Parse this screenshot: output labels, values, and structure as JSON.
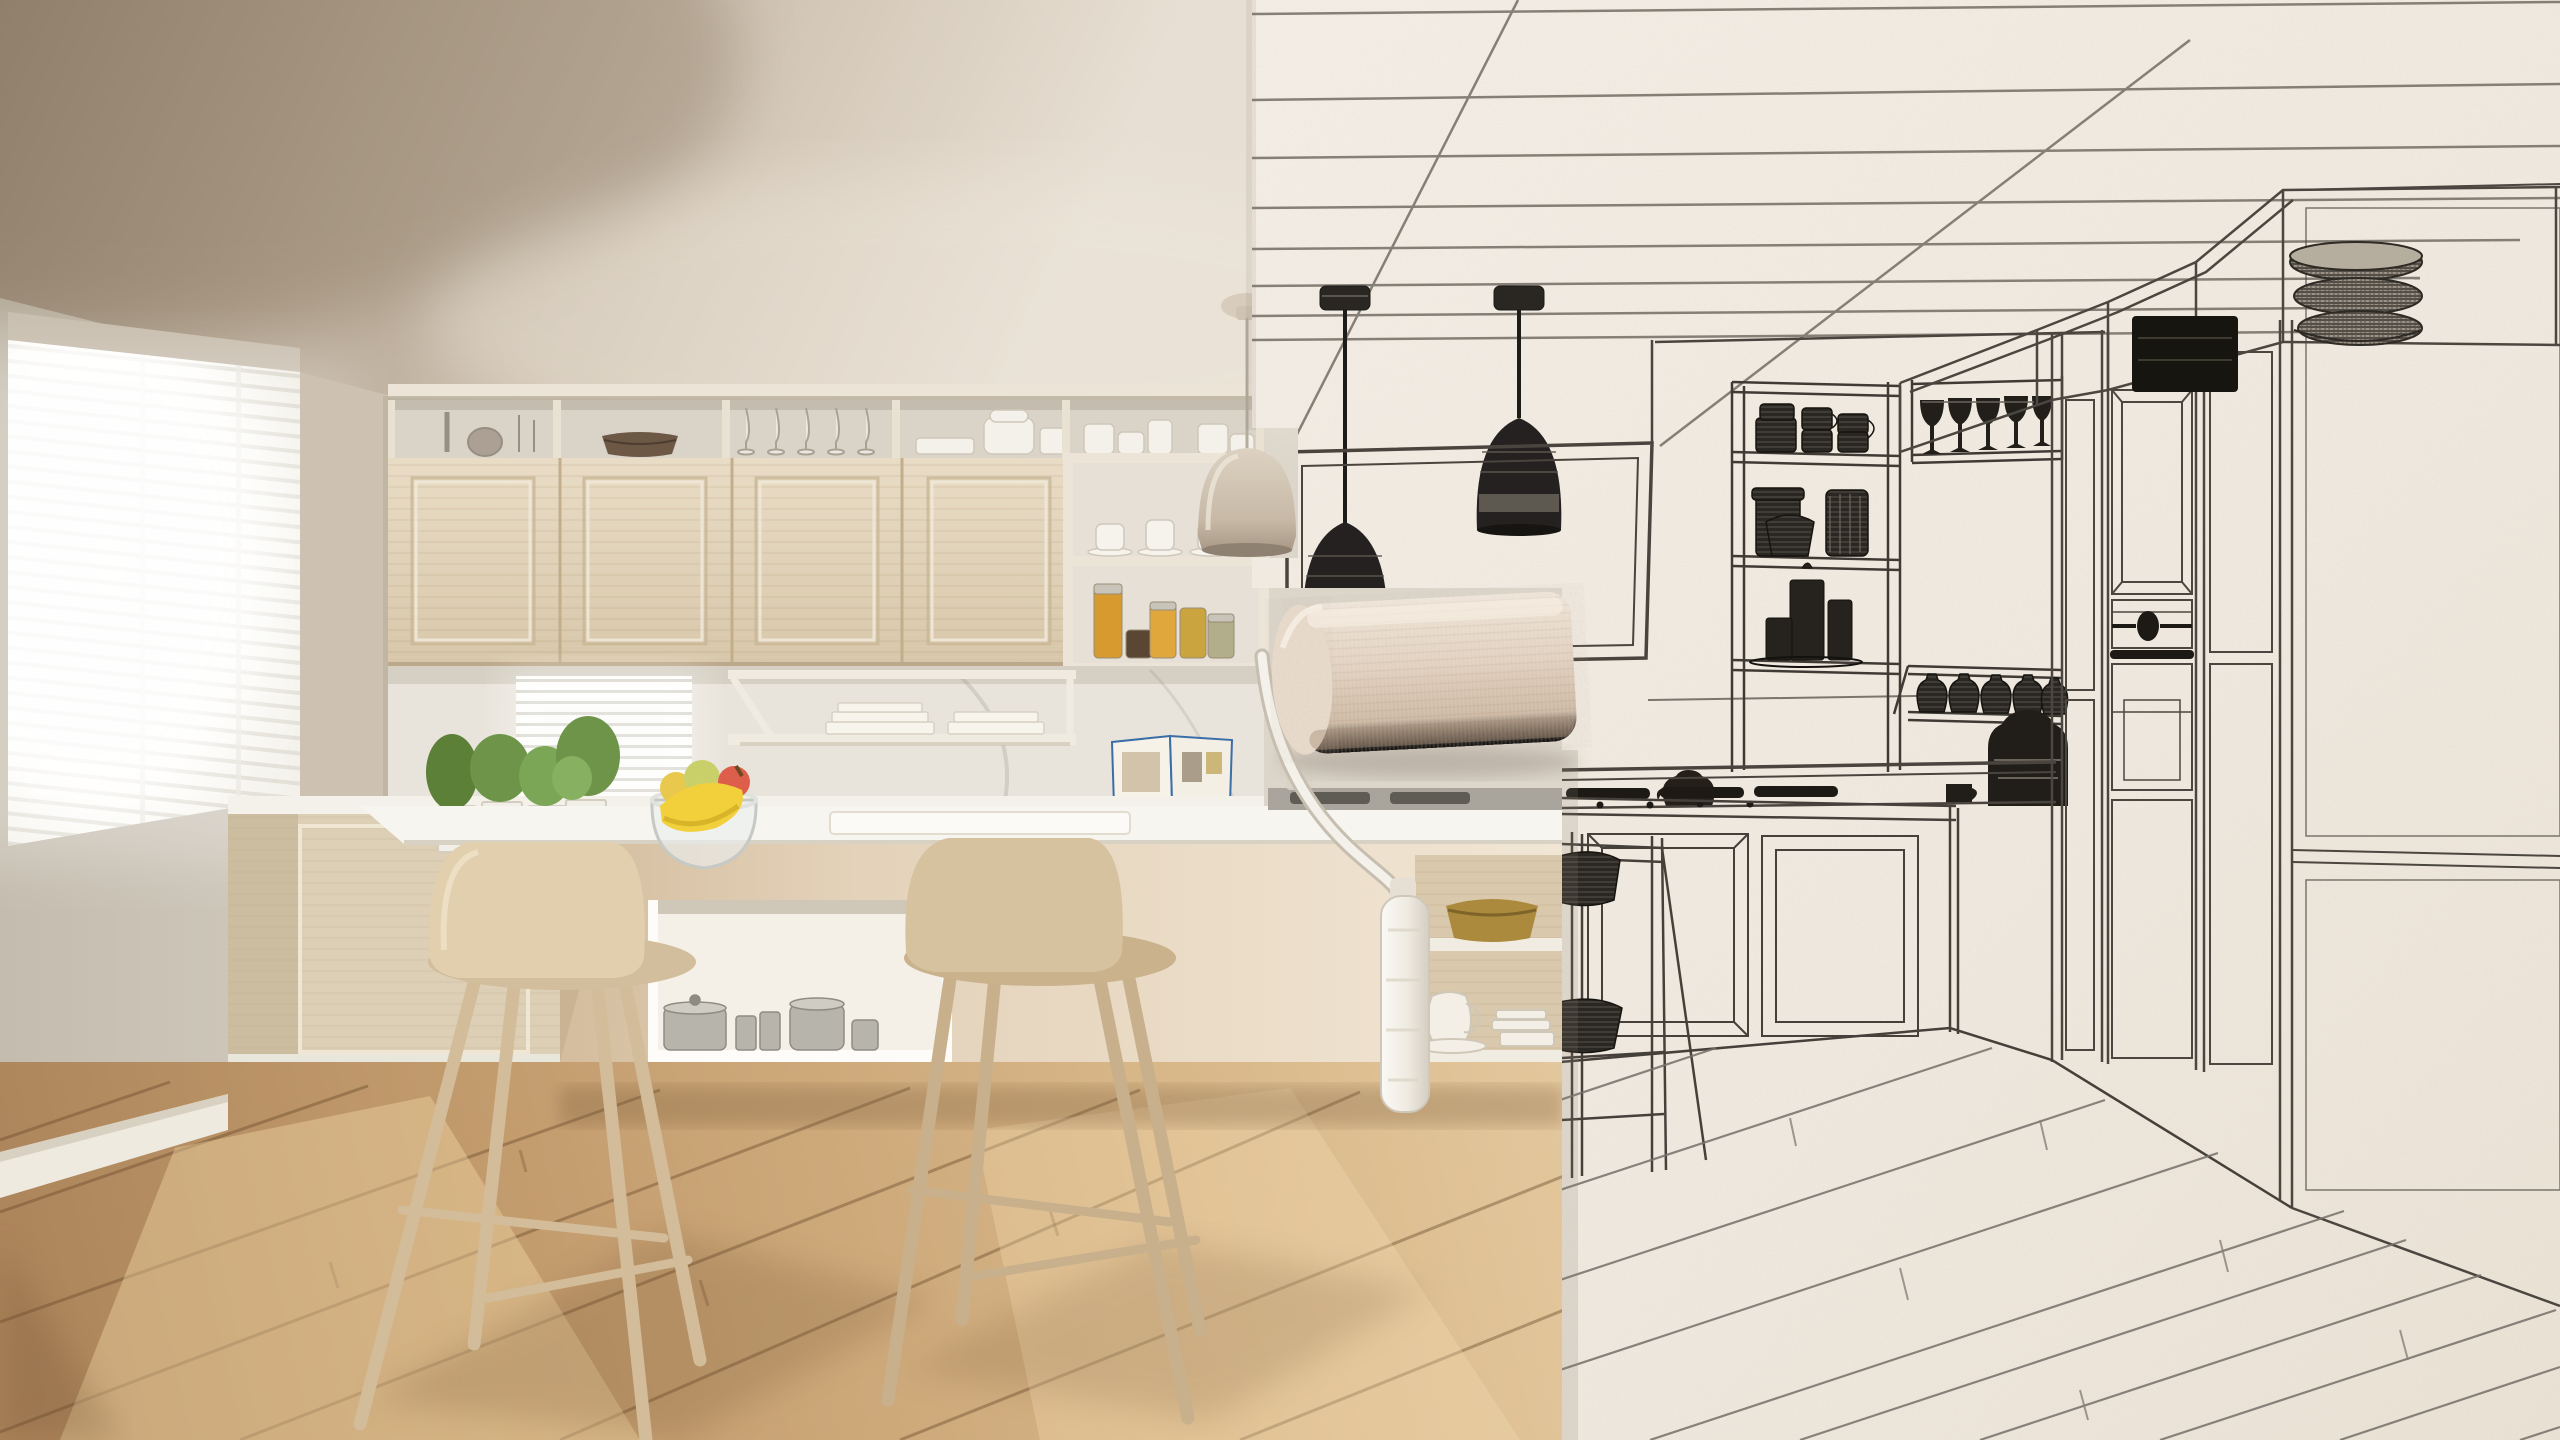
{
  "meta": {
    "type": "photo-composite",
    "description": "Concept image: a paint roller 'paints' a real photographic modern white and wooden kitchen over a black-and-white blueprint pencil sketch of the same kitchen. Left half is the finished photo, right half is the wireframe drawing on textured paper."
  },
  "scene": {
    "left_photo": {
      "label": "Photographic side: minimalist scandinavian kitchen with wooden cabinets",
      "objects": [
        "venetian-blind window with bright daylight",
        "taupe ceiling in soft shadow",
        "glass display top cabinets with vases, wicker bowl, champagne flutes and white bowls",
        "four light-oak shaker cabinet doors",
        "open shelf unit with coffee cups and amber spice jars",
        "white under-cabinet rack with white books",
        "small bright blind window over marble backsplash",
        "potted green herbs in square white planters",
        "glass fruit bowl with bananas, pear and peach",
        "open cookbook on stand",
        "white marble island countertop",
        "island niche with steel pots",
        "island end shelves with brass bowl, white jug and plates",
        "two tall wooden bar stools",
        "cream pendant lamp",
        "warm oak plank floor with sun patches"
      ]
    },
    "right_sketch": {
      "label": "Blueprint side: pencil wireframe drawing of the kitchen on textured paper",
      "objects": [
        "ruled ceiling perspective lines",
        "two black wireframe dome pendant lamps",
        "double-line hood / window frame over the cooktop",
        "open shelf unit with hatched mugs, jars and candles",
        "row of dark wine glasses",
        "row of small carafes on an angled shelf",
        "coffee machine and espresso cup silhouettes",
        "teapot silhouette on the counter",
        "gas cooktop grates",
        "tall cabinet column with built-in oven, dial and handle",
        "plain fridge panels with seam lines",
        "display cases on top with woven basket stack and black box",
        "sketched island panels and bar stool frame",
        "diagonal floor plank lines"
      ]
    },
    "paint_roller": {
      "label": "Cream paint roller rolling the photographic reality over the sketch",
      "parts": [
        "fabric roller head",
        "bent white metal rod",
        "white roller grip handle"
      ]
    }
  },
  "palette": {
    "ceiling_dark": "#9a8a78",
    "ceiling_light": "#e6ded2",
    "wall": "#d6d0c6",
    "cabinet_wood": "#e3d6bf",
    "cabinet_frame": "#ece5d7",
    "marble": "#e9e4db",
    "counter_white": "#f5f2ec",
    "island_cream": "#ecdfcc",
    "stool_wood": "#dcc6a6",
    "floor_light": "#e2c496",
    "floor_dark": "#b28a5e",
    "paper": "#f3ede4",
    "sketch_line": "#55504a",
    "sketch_ink": "#242120",
    "roller_cream": "#e6d5c3",
    "handle_white": "#f6f3ed",
    "banana_yellow": "#f2d03c",
    "herb_green": "#6d9448",
    "spice_amber": "#d69a2e",
    "brass": "#b08d3f"
  }
}
